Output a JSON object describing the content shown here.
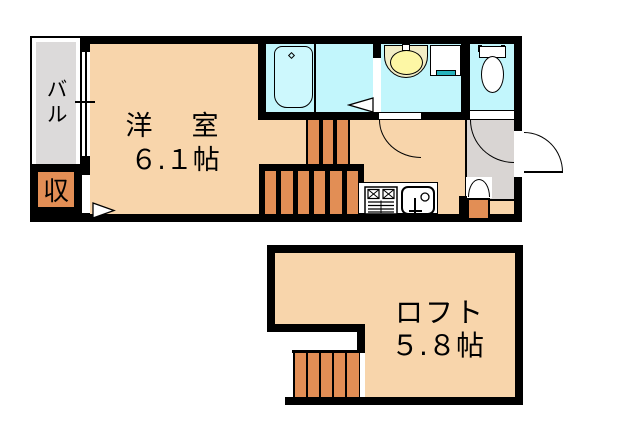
{
  "upper_plan": {
    "balcony": {
      "label": "バル"
    },
    "closet": {
      "label": "収"
    },
    "room": {
      "name": "洋　室",
      "size": "６.１帖"
    }
  },
  "loft_plan": {
    "room": {
      "name": "ロフト",
      "size": "５.８帖"
    }
  },
  "colors": {
    "wall": "#000000",
    "floor": "#f8d5ab",
    "stair": "#e28e55",
    "wet": "#c2f6fc",
    "tub": "#cdf8fd",
    "balc": "#dcdada",
    "genkan": "#d9d5d3",
    "basin": "#f2edc6",
    "bowl": "#fdf7a5",
    "teal": "#26b3bc"
  }
}
